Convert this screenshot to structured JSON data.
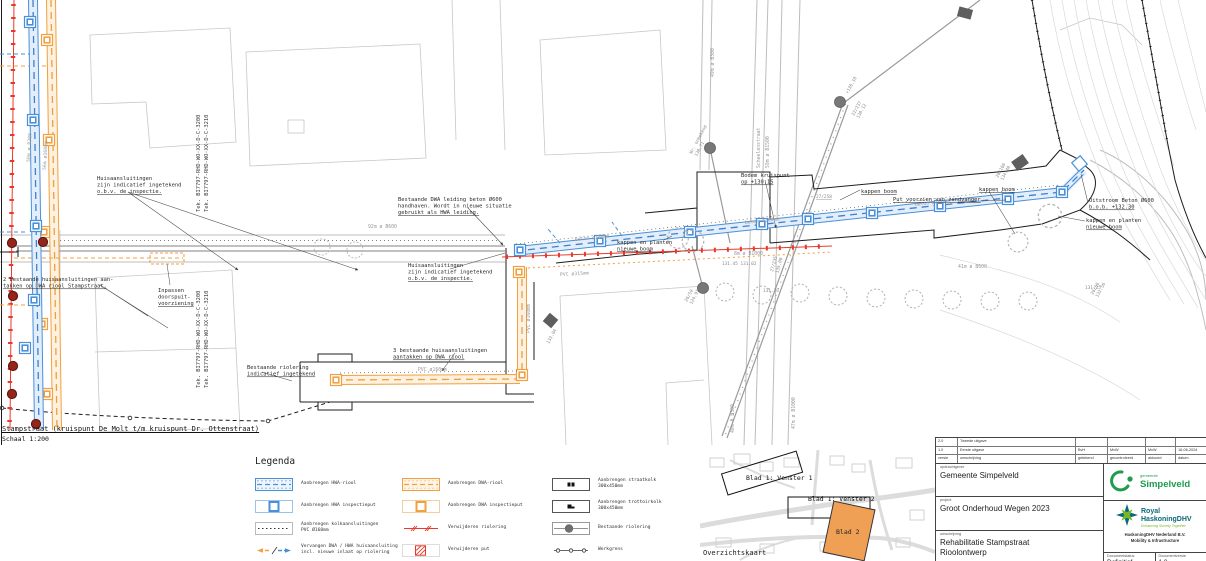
{
  "caption": {
    "title": "Stampstraat (kruispunt De Molt t/m kruispunt Dr. Ottenstraat)",
    "scale": "Schaal 1:200"
  },
  "drawing": {
    "tek": {
      "a": "Tek. BI7797-RHD-WO-XX-D-C-3200",
      "b": "Tek. BI7797-RHD-WO-XX-D-C-3210"
    },
    "notes": {
      "huis": [
        "Huisaansluitingen",
        "zijn indicatief ingetekend",
        "o.b.v. de inspectie."
      ],
      "aantakken2": [
        "2 bestaande huisaansluitingen aan-",
        "takken op DWA riool Stampstraat."
      ],
      "inpassen": [
        "Inpassen",
        "doorspuit-",
        "voorziening"
      ],
      "bestriool": [
        "Bestaande riolering",
        "indicatief ingetekend"
      ],
      "aantakken3": [
        "3 bestaande huisaansluitingen",
        "aantakken op DWA riool"
      ],
      "bestdwa": [
        "Bestaande DWA leiding beton Ø600",
        "handhaven. Wordt in nieuwe situatie",
        "gebruikt als HWA leiding."
      ],
      "bodem": [
        "Bodem kruispunt",
        "op +130.15"
      ],
      "kappenboom": "kappen boom",
      "kappenplanten": [
        "kappen en planten",
        "nieuwe boom"
      ],
      "zandvanger": "Put voorzien van zandvanger",
      "uitstroom": [
        "Uitstroom Beton Ø600",
        "b.o.b. +132.30"
      ]
    },
    "pipes": {
      "p92": "92m ø B600",
      "street": "Scheelenstraat",
      "p59": "59m ø B1500",
      "p8": "8m ø B1000",
      "p41": "41m ø B600",
      "p40": "40m ø B300",
      "p47": "47m ø B1000",
      "p49": "49m ø B300",
      "beton300": "beton ø300mm",
      "pvc315": "PVC ø315mm",
      "pvc160": "PVC ø160mm",
      "p50": "50m ø B300",
      "p56": "56m ø160mm"
    },
    "spots": {
      "s1": "131.45 131.02",
      "s2": "131.76",
      "s3": "131.25",
      "s4": "+130.18",
      "s5": "22/237",
      "s6": "130.12",
      "s7": "Nr. onbekend",
      "s8": "130.71",
      "s9": "27/258",
      "s10": "26/50",
      "s11": "124.97",
      "s12": "26/66",
      "s13": "132.56",
      "s14": "27/235",
      "s15": "135.00",
      "s16": "26/166",
      "s17": "134.40",
      "s18": "133.04"
    }
  },
  "legend": {
    "title": "Legenda",
    "col1": [
      {
        "label": "Aanbrengen HWA-riool",
        "label2": ""
      },
      {
        "label": "Aanbrengen HWA inspectieput",
        "label2": ""
      },
      {
        "label": "Aanbrengen kolkaansluitingen",
        "label2": "PVC Ø160mm"
      },
      {
        "label": "Vervangen DWA / HWA huisaansluiting",
        "label2": "incl. nieuwe inlaat op riolering"
      }
    ],
    "col2": [
      {
        "label": "Aanbrengen DWA-riool",
        "label2": ""
      },
      {
        "label": "Aanbrengen DWA inspectieput",
        "label2": ""
      },
      {
        "label": "Verwijderen riolering",
        "label2": ""
      },
      {
        "label": "Verwijderen put",
        "label2": ""
      }
    ],
    "col3": [
      {
        "label": "Aanbrengen straatkolk",
        "label2": "300x450mm"
      },
      {
        "label": "Aanbrengen trottoirkolk",
        "label2": "300x450mm"
      },
      {
        "label": "Bestaande riolering",
        "label2": ""
      },
      {
        "label": "Werkgrens",
        "label2": ""
      }
    ]
  },
  "overview": {
    "v1": "Blad 1: Venster 1",
    "v2": "Blad 1: Venster 2",
    "b2": "Blad 2",
    "caption": "Overzichtskaart",
    "blad2_color": "#f0a055"
  },
  "titleblock": {
    "revisions": {
      "r2": {
        "versie": "2.0",
        "omschrijving": "Tweede uitgave"
      },
      "r1": {
        "versie": "1.0",
        "omschrijving": "Eerste uitgave",
        "getekend": "BvH",
        "gecontroleerd": "MvW",
        "akkoord": "MvW",
        "datum": "16-06-2024"
      },
      "headers": {
        "versie": "versie",
        "omschrijving": "omschrijving",
        "getekend": "getekend",
        "gecontroleerd": "gecontroleerd",
        "akkoord": "akkoord",
        "datum": "datum"
      }
    },
    "opdrachtgever_label": "opdrachtgever",
    "opdrachtgever": "Gemeente Simpelveld",
    "project_label": "project",
    "project": "Groot Onderhoud Wegen 2023",
    "omschrijving_label": "omschrijving",
    "omschrijving1": "Rehabilitatie Stampstraat",
    "omschrijving2": "Rioolontwerp",
    "status_label": "Documentstatus",
    "status": "Definitief",
    "versie_label": "Documentversie",
    "versie": "1.0",
    "logo_simpelveld": {
      "gemeente": "gemeente",
      "name": "Simpelveld",
      "green": "#1d9c4c"
    },
    "logo_rhdhv": {
      "name1": "Royal",
      "name2": "HaskoningDHV",
      "tagline": "Enhancing Society Together",
      "company": "HaskoningDHV Nederland B.V.",
      "division": "Mobility & Infrastructure",
      "teal": "#0a6977",
      "green": "#76b82a"
    }
  },
  "colors": {
    "hwa_blue": "#4a90d9",
    "dwa_orange": "#f0a040",
    "remove_red": "#e8392b",
    "existing_gray": "#9a9a9a",
    "werkgrens_black": "#1c1c1c"
  }
}
